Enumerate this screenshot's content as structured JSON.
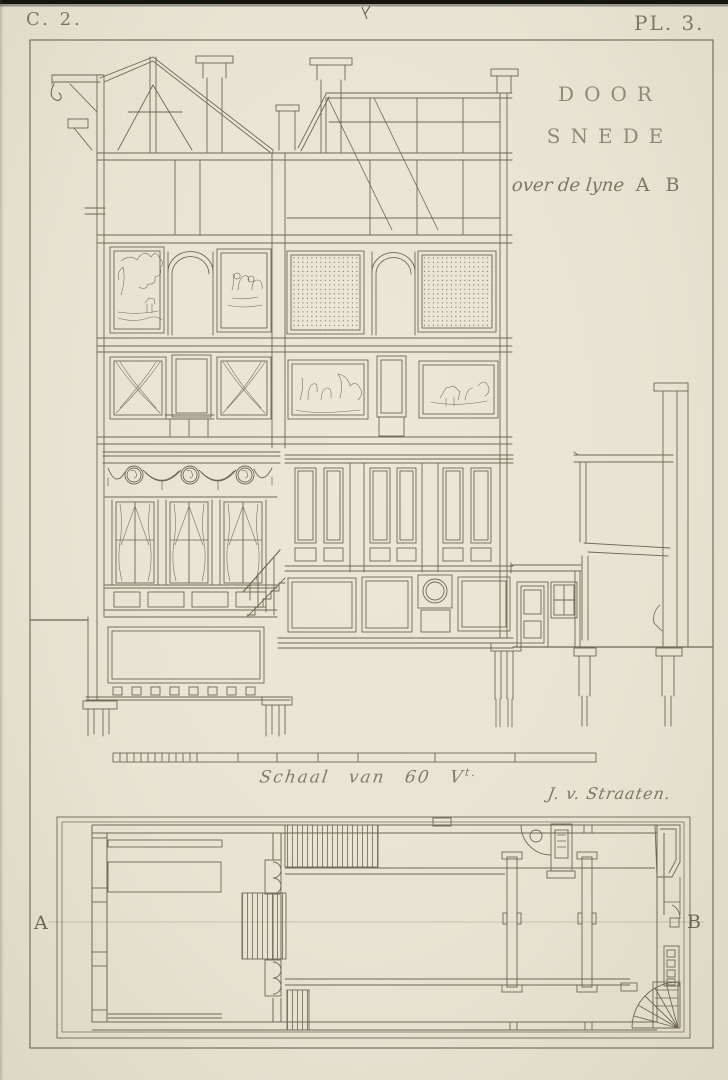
{
  "page": {
    "paper_color": "#e8e4d3",
    "ink_color": "#6e6755",
    "faint_ink_color": "#8e8777"
  },
  "header": {
    "series_label": "C. 2.",
    "plate_label": "PL. 3."
  },
  "title": {
    "line1": "DOOR",
    "line2": "SNEDE",
    "subtitle_script": "over de lyne",
    "subtitle_points": "A B"
  },
  "scale": {
    "caption_main": "Schaal van 60 V",
    "caption_sup": "t.",
    "signature": "J. v. Straaten."
  },
  "plan": {
    "left_label": "A",
    "right_label": "B"
  }
}
